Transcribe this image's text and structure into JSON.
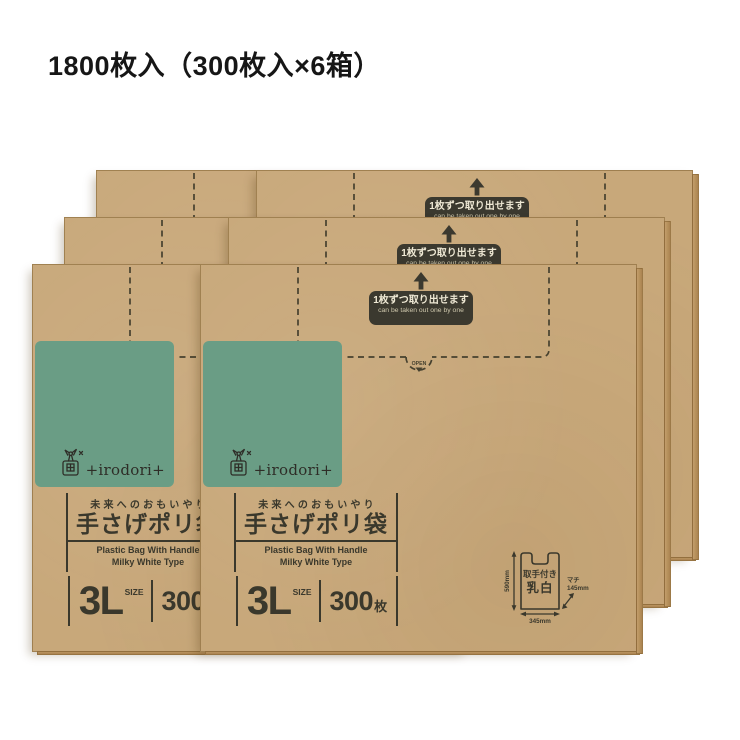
{
  "page_title": "1800枚入（300枚入×6箱）",
  "box": {
    "dispenser_badge": {
      "jp": "1枚ずつ取り出せます",
      "en": "can be taken out one by one"
    },
    "open_label": "OPEN",
    "logo_text": "+irodori+",
    "tagline": "未来へのおもいやり",
    "product_name": "手さげポリ袋",
    "product_sub_line1": "Plastic Bag With Handle",
    "product_sub_line2": "Milky White Type",
    "size_value": "3L",
    "size_unit_label": "SIZE",
    "sheet_count": "300",
    "sheet_unit": "枚",
    "spec_diagram": {
      "bag_type_line1": "取手付き",
      "bag_type_line2": "乳白",
      "height": "590mm",
      "width": "345mm",
      "gusset_label": "マチ",
      "gusset_value": "145mm"
    }
  },
  "colors": {
    "kraft": "#c8a87a",
    "green": "#6a9d85",
    "ink": "#3a382c",
    "badge_bg": "#3b392f",
    "badge_text": "#efe9d5"
  }
}
